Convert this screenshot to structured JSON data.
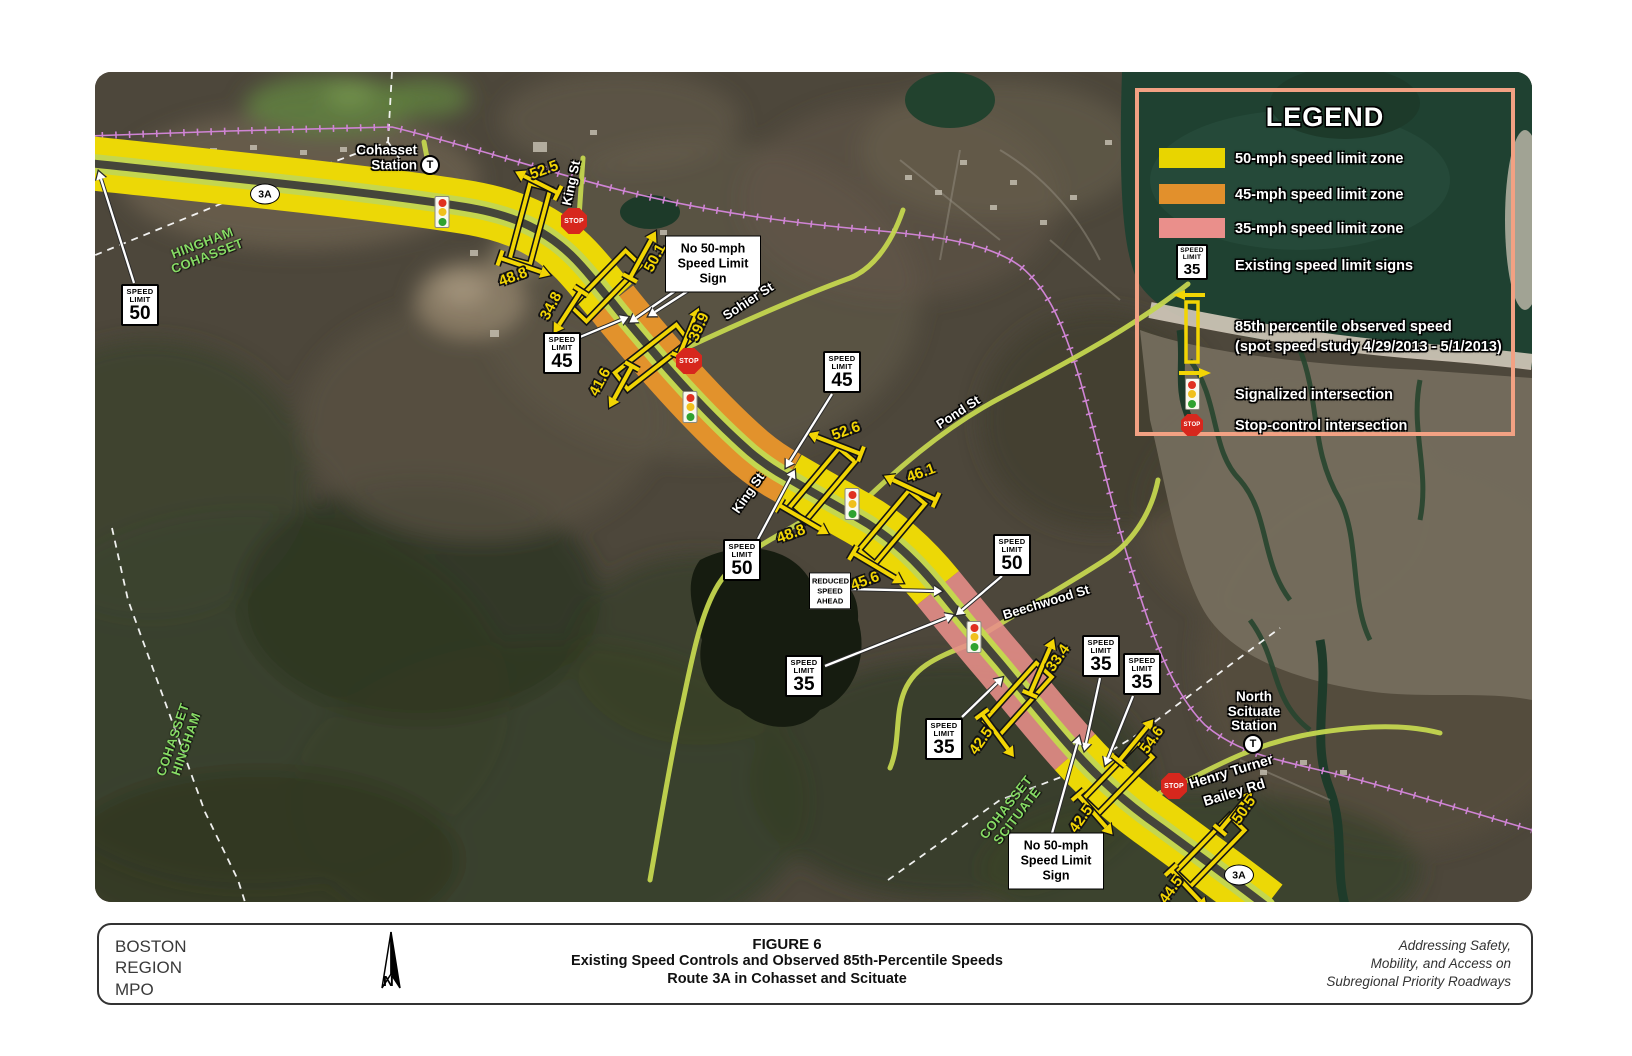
{
  "colors": {
    "zone_50": "#ecd806",
    "zone_45": "#e2922c",
    "zone_35": "#e8908a",
    "road_centerline": "#c4d64f",
    "road_surface": "#45453a",
    "railroad": "#cf84d4",
    "legend_border": "#f2a183",
    "speed_value_text": "#f2d504",
    "town_boundary_label": "#86da64",
    "stop_sign": "#d7271d",
    "water": "#1f4131"
  },
  "legend": {
    "title": "LEGEND",
    "items": [
      {
        "type": "swatch50",
        "label": "50-mph speed limit zone"
      },
      {
        "type": "swatch45",
        "label": "45-mph speed limit zone"
      },
      {
        "type": "swatch35",
        "label": "35-mph speed limit zone"
      },
      {
        "type": "sign",
        "sign_word1": "SPEED",
        "sign_word2": "LIMIT",
        "sign_value": "35",
        "label": "Existing speed limit signs"
      },
      {
        "type": "study",
        "label": "85th percentile observed speed",
        "label2": "(spot speed study 4/29/2013 - 5/1/2013)"
      },
      {
        "type": "signal",
        "label": "Signalized intersection"
      },
      {
        "type": "stop",
        "stop_text": "STOP",
        "label": "Stop-control intersection"
      }
    ]
  },
  "map": {
    "stop_text": "STOP",
    "t_symbol": "T",
    "sign_word1": "SPEED",
    "sign_word2": "LIMIT",
    "shields": [
      {
        "label": "3A",
        "x": 265,
        "y": 194
      },
      {
        "label": "3A",
        "x": 1239,
        "y": 875
      }
    ],
    "stations": [
      {
        "lines": [
          "Cohasset",
          "Station"
        ],
        "x": 417,
        "y": 158,
        "align": "right",
        "t_x": 430,
        "t_y": 165
      },
      {
        "lines": [
          "North",
          "Scituate",
          "Station"
        ],
        "x": 1254,
        "y": 712,
        "align": "center",
        "t_x": 1253,
        "t_y": 744
      }
    ],
    "street_labels": [
      {
        "text": "King St",
        "x": 571,
        "y": 183,
        "rot": -78,
        "size": 13
      },
      {
        "text": "Sohier St",
        "x": 748,
        "y": 301,
        "rot": -33,
        "size": 13
      },
      {
        "text": "Pond St",
        "x": 958,
        "y": 412,
        "rot": -33,
        "size": 13
      },
      {
        "text": "King St",
        "x": 748,
        "y": 493,
        "rot": -55,
        "size": 13
      },
      {
        "text": "Beechwood St",
        "x": 1046,
        "y": 602,
        "rot": -17,
        "size": 13
      },
      {
        "text": "Henry Turner",
        "x": 1231,
        "y": 771,
        "rot": -17,
        "size": 14
      },
      {
        "text": "Bailey Rd",
        "x": 1234,
        "y": 792,
        "rot": -17,
        "size": 14
      }
    ],
    "boundary_labels": [
      {
        "lines": [
          "HINGHAM",
          "COHASSET"
        ],
        "x": 205,
        "y": 250,
        "rot": -21
      },
      {
        "lines": [
          "COHASSET",
          "HINGHAM"
        ],
        "x": 180,
        "y": 742,
        "rot": -71
      },
      {
        "lines": [
          "COHASSET",
          "SCITUATE"
        ],
        "x": 1012,
        "y": 812,
        "rot": -52
      }
    ],
    "stops": [
      {
        "x": 574,
        "y": 221
      },
      {
        "x": 689,
        "y": 361
      },
      {
        "x": 1174,
        "y": 786
      }
    ],
    "signals": [
      {
        "x": 442,
        "y": 212
      },
      {
        "x": 690,
        "y": 407
      },
      {
        "x": 852,
        "y": 504
      },
      {
        "x": 974,
        "y": 637
      }
    ],
    "speed_limit_signs": [
      {
        "value": "50",
        "x": 140,
        "y": 305,
        "arrows": [
          [
            134,
            283,
            101,
            179
          ]
        ]
      },
      {
        "value": "45",
        "x": 562,
        "y": 353,
        "arrows": [
          [
            580,
            337,
            621,
            320
          ]
        ]
      },
      {
        "value": "45",
        "x": 842,
        "y": 372,
        "arrows": [
          [
            832,
            394,
            790,
            461
          ]
        ]
      },
      {
        "value": "50",
        "x": 742,
        "y": 560,
        "arrows": [
          [
            758,
            539,
            791,
            477
          ]
        ]
      },
      {
        "value": "50",
        "x": 1012,
        "y": 555,
        "arrows": [
          [
            1002,
            576,
            962,
            610
          ]
        ]
      },
      {
        "value": "35",
        "x": 804,
        "y": 676,
        "arrows": [
          [
            825,
            666,
            946,
            618
          ]
        ]
      },
      {
        "value": "35",
        "x": 944,
        "y": 739,
        "arrows": [
          [
            962,
            717,
            997,
            683
          ]
        ]
      },
      {
        "value": "35",
        "x": 1101,
        "y": 656,
        "arrows": [
          [
            1100,
            678,
            1086,
            743
          ]
        ]
      },
      {
        "value": "35",
        "x": 1142,
        "y": 674,
        "arrows": [
          [
            1133,
            696,
            1108,
            758
          ]
        ]
      }
    ],
    "callouts": [
      {
        "lines": [
          "No 50-mph",
          "Speed Limit",
          "Sign"
        ],
        "x": 713,
        "y": 264,
        "w": 86,
        "small": false,
        "arrows": [
          [
            678,
            289,
            636,
            318
          ],
          [
            691,
            289,
            655,
            312
          ]
        ]
      },
      {
        "lines": [
          "REDUCED",
          "SPEED",
          "AHEAD"
        ],
        "x": 830,
        "y": 591,
        "w": 36,
        "small": true,
        "arrows": [
          [
            849,
            589,
            934,
            591
          ]
        ]
      },
      {
        "lines": [
          "No 50-mph",
          "Speed Limit",
          "Sign"
        ],
        "x": 1056,
        "y": 861,
        "w": 86,
        "small": false,
        "arrows": [
          [
            1051,
            837,
            1077,
            744
          ]
        ]
      }
    ],
    "study_sites": [
      {
        "cx": 530,
        "cy": 224,
        "rot": 15
      },
      {
        "cx": 606,
        "cy": 286,
        "rot": 44
      },
      {
        "cx": 652,
        "cy": 357,
        "rot": 52
      },
      {
        "cx": 822,
        "cy": 485,
        "rot": 40
      },
      {
        "cx": 892,
        "cy": 527,
        "rot": 40
      },
      {
        "cx": 1018,
        "cy": 699,
        "rot": 42
      },
      {
        "cx": 1118,
        "cy": 778,
        "rot": 44
      },
      {
        "cx": 1210,
        "cy": 851,
        "rot": 44
      }
    ],
    "speeds": [
      {
        "value": "52.5",
        "lx": 544,
        "ly": 170,
        "rot": -20,
        "arrow": [
          558,
          193,
          524,
          176
        ]
      },
      {
        "value": "48.8",
        "lx": 513,
        "ly": 277,
        "rot": -20,
        "arrow": [
          500,
          258,
          541,
          272
        ]
      },
      {
        "value": "50.1",
        "lx": 655,
        "ly": 258,
        "rot": -62,
        "arrow": [
          630,
          278,
          651,
          240
        ]
      },
      {
        "value": "34.8",
        "lx": 551,
        "ly": 306,
        "rot": -62,
        "arrow": [
          581,
          291,
          559,
          325
        ]
      },
      {
        "value": "39.9",
        "lx": 699,
        "ly": 327,
        "rot": -66,
        "arrow": [
          679,
          356,
          695,
          317
        ]
      },
      {
        "value": "41.6",
        "lx": 600,
        "ly": 382,
        "rot": -62,
        "arrow": [
          632,
          366,
          614,
          399
        ]
      },
      {
        "value": "52.6",
        "lx": 846,
        "ly": 431,
        "rot": -20,
        "arrow": [
          861,
          454,
          817,
          437
        ]
      },
      {
        "value": "48.8",
        "lx": 791,
        "ly": 534,
        "rot": -20,
        "arrow": [
          779,
          505,
          820,
          529
        ]
      },
      {
        "value": "46.1",
        "lx": 921,
        "ly": 473,
        "rot": -20,
        "arrow": [
          936,
          500,
          893,
          480
        ]
      },
      {
        "value": "45.6",
        "lx": 865,
        "ly": 581,
        "rot": -20,
        "arrow": [
          853,
          553,
          895,
          578
        ]
      },
      {
        "value": "33.4",
        "lx": 1058,
        "ly": 658,
        "rot": -55,
        "arrow": [
          1030,
          694,
          1050,
          648
        ]
      },
      {
        "value": "42.5",
        "lx": 981,
        "ly": 741,
        "rot": -55,
        "arrow": [
          982,
          714,
          1008,
          749
        ]
      },
      {
        "value": "54.6",
        "lx": 1152,
        "ly": 740,
        "rot": -55,
        "arrow": [
          1119,
          761,
          1147,
          727
        ]
      },
      {
        "value": "42.5",
        "lx": 1081,
        "ly": 819,
        "rot": -55,
        "arrow": [
          1078,
          795,
          1106,
          827
        ]
      },
      {
        "value": "50.5",
        "lx": 1244,
        "ly": 810,
        "rot": -55,
        "arrow": [
          1220,
          830,
          1246,
          799
        ]
      },
      {
        "value": "44.5",
        "lx": 1171,
        "ly": 890,
        "rot": -55,
        "arrow": [
          1171,
          870,
          1200,
          901
        ]
      }
    ]
  },
  "footer": {
    "agency_lines": [
      "BOSTON",
      "REGION",
      "MPO"
    ],
    "north_label": "N",
    "figure_label": "FIGURE 6",
    "title_line1": "Existing Speed Controls and Observed 85th-Percentile Speeds",
    "title_line2": "Route 3A in Cohasset and Scituate",
    "tagline_lines": [
      "Addressing Safety,",
      "Mobility, and Access on",
      "Subregional Priority Roadways"
    ]
  }
}
